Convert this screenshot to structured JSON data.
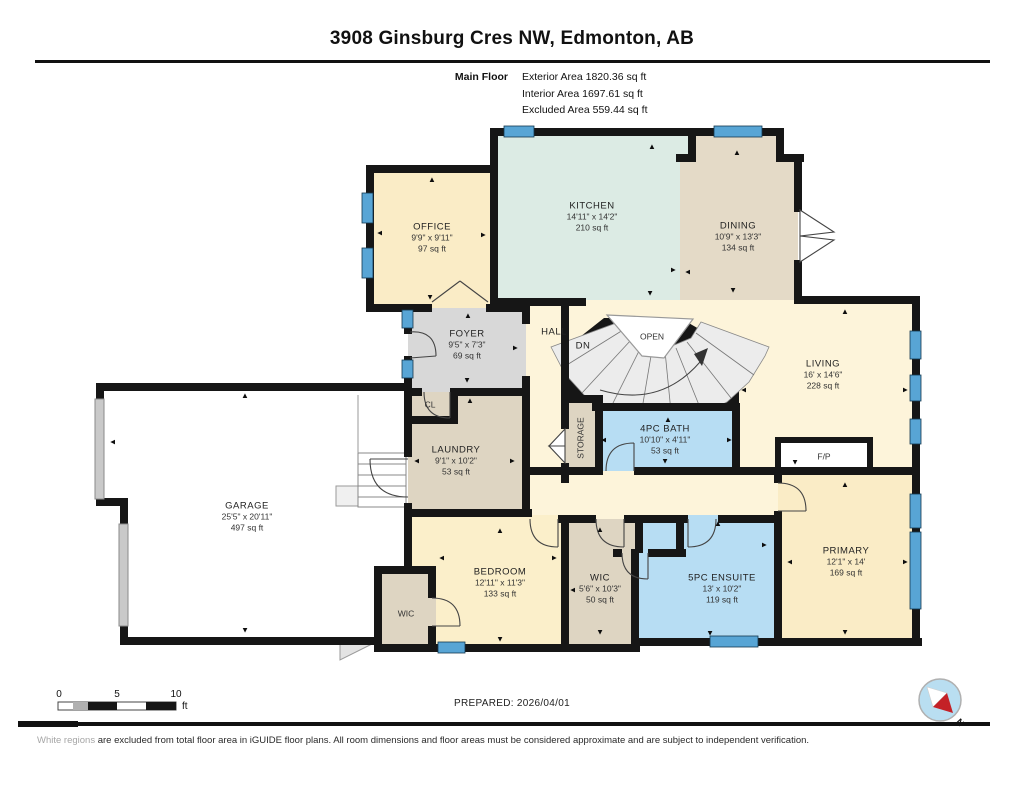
{
  "header": {
    "title": "3908 Ginsburg Cres NW, Edmonton, AB",
    "floor_label": "Main Floor",
    "exterior": "Exterior Area 1820.36 sq ft",
    "interior": "Interior Area 1697.61 sq ft",
    "excluded": "Excluded Area 559.44 sq ft"
  },
  "rooms": {
    "office": {
      "name": "OFFICE",
      "dims": "9'9\" x 9'11\"",
      "area": "97 sq ft"
    },
    "kitchen": {
      "name": "KITCHEN",
      "dims": "14'11\" x 14'2\"",
      "area": "210 sq ft"
    },
    "dining": {
      "name": "DINING",
      "dims": "10'9\" x 13'3\"",
      "area": "134 sq ft"
    },
    "foyer": {
      "name": "FOYER",
      "dims": "9'5\" x 7'3\"",
      "area": "69 sq ft"
    },
    "living": {
      "name": "LIVING",
      "dims": "16' x 14'6\"",
      "area": "228 sq ft"
    },
    "laundry": {
      "name": "LAUNDRY",
      "dims": "9'1\" x 10'2\"",
      "area": "53 sq ft"
    },
    "bath": {
      "name": "4PC BATH",
      "dims": "10'10\" x 4'11\"",
      "area": "53 sq ft"
    },
    "garage": {
      "name": "GARAGE",
      "dims": "25'5\" x 20'11\"",
      "area": "497 sq ft"
    },
    "bedroom": {
      "name": "BEDROOM",
      "dims": "12'11\" x 11'3\"",
      "area": "133 sq ft"
    },
    "wic_primary": {
      "name": "WIC",
      "dims": "5'6\" x 10'3\"",
      "area": "50 sq ft"
    },
    "ensuite": {
      "name": "5PC ENSUITE",
      "dims": "13' x 10'2\"",
      "area": "119 sq ft"
    },
    "primary": {
      "name": "PRIMARY",
      "dims": "12'1\" x 14'",
      "area": "169 sq ft"
    },
    "wic_bedroom": {
      "name": "WIC"
    },
    "hall": {
      "name": "HALL"
    },
    "storage": {
      "name": "STORAGE"
    },
    "cl": {
      "name": "CL"
    },
    "fireplace": {
      "name": "F/P"
    },
    "stair_dn": {
      "name": "DN"
    },
    "stair_open": {
      "name": "OPEN"
    }
  },
  "scale_bar": {
    "zero": "0",
    "five": "5",
    "ten": "10",
    "unit": "ft"
  },
  "footer": {
    "prepared": "PREPARED: 2026/04/01",
    "disclaimer_highlight": "White regions",
    "disclaimer_rest": " are excluded from total floor area in iGUIDE floor plans. All room dimensions and floor areas must be considered approximate and are subject to independent verification."
  },
  "compass": {
    "north_label": "N"
  },
  "glyphs": {
    "arrow": "▲"
  },
  "colors": {
    "wall": "#161616",
    "cream_room": "#faecc6",
    "cream_hall": "#fdf4da",
    "kitchen_green": "#dcebe4",
    "beige": "#ded5c2",
    "dining_beige": "#e4dac7",
    "foyer_gray": "#d8d8d8",
    "bath_blue": "#b7ddf3",
    "window_blue": "#58a5d5",
    "compass_red": "#c42127",
    "compass_blue": "#b9def1"
  }
}
